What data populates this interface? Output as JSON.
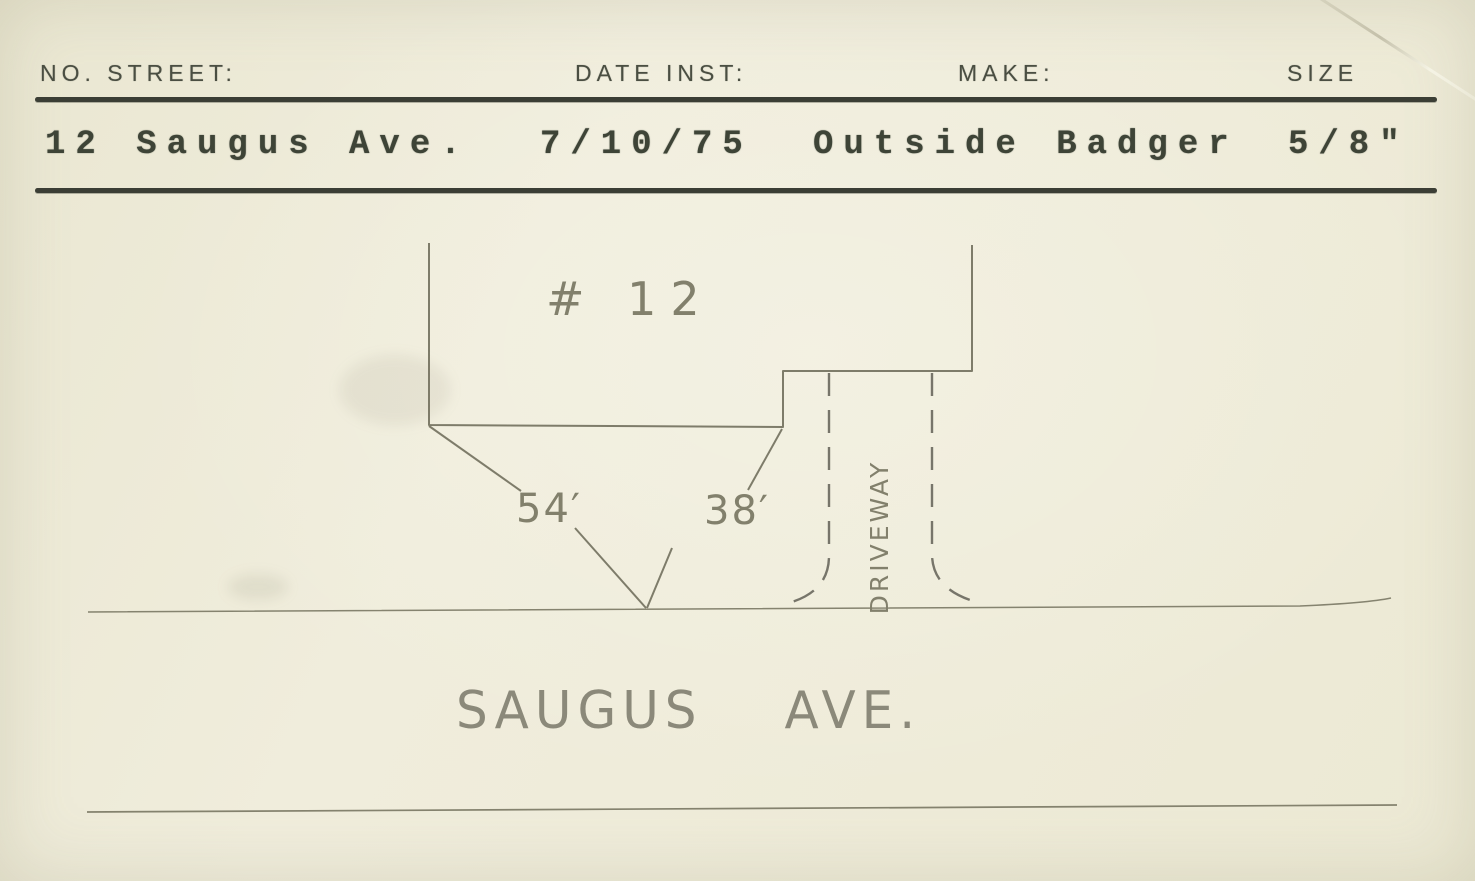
{
  "header": {
    "fields": [
      {
        "label": "NO. STREET:",
        "value": "12 Saugus Ave."
      },
      {
        "label": "DATE INST:",
        "value": "7/10/75"
      },
      {
        "label": "MAKE:",
        "value": "Outside Badger"
      },
      {
        "label": "SIZE",
        "value": "5/8\""
      }
    ]
  },
  "sketch": {
    "house_label": "# 12",
    "measurement_left": "54′",
    "measurement_right": "38′",
    "driveway_label": "DRIVEWAY",
    "street_name": "SAUGUS AVE."
  },
  "colors": {
    "paper": "#efecdb",
    "printed_ink": "#4a4e42",
    "typewriter_ink": "#3e4437",
    "pencil": "#82806c",
    "rule": "#3b3e35"
  }
}
